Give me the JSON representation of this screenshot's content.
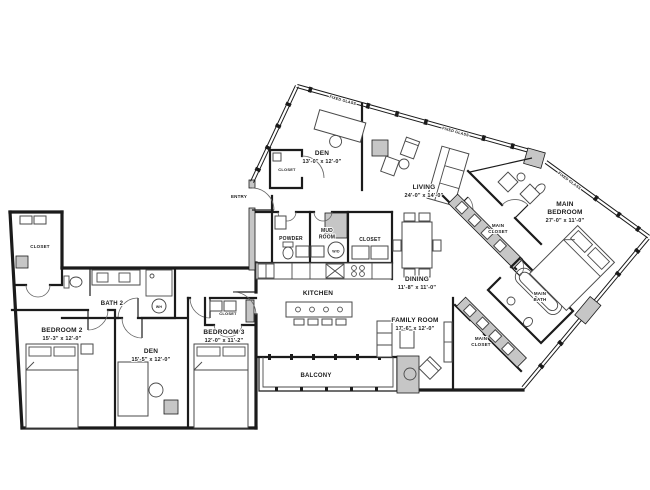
{
  "rooms": {
    "den_upper": {
      "name": "DEN",
      "dims": "13'-0\" x 12'-0\""
    },
    "living": {
      "name": "LIVING",
      "dims": "24'-0\" x 14'-0\""
    },
    "main_bedroom": {
      "l1": "MAIN",
      "l2": "BEDROOM",
      "dims": "27'-0\" x 11'-0\""
    },
    "dining": {
      "name": "DINING",
      "dims": "11'-8\" x 11'-0\""
    },
    "kitchen": {
      "name": "KITCHEN"
    },
    "family_room": {
      "name": "FAMILY ROOM",
      "dims": "17'-6\" x 12'-0\""
    },
    "bedroom_2": {
      "name": "BEDROOM 2",
      "dims": "15'-3\" x 12'-0\""
    },
    "den_lower": {
      "name": "DEN",
      "dims": "15'-5\" x 12'-0\""
    },
    "bedroom_3": {
      "name": "BEDROOM 3",
      "dims": "12'-0\" x 11'-2\""
    },
    "bath_2": {
      "name": "BATH 2"
    },
    "powder": {
      "name": "POWDER"
    },
    "mud_room": {
      "l1": "MUD",
      "l2": "ROOM"
    },
    "balcony": {
      "name": "BALCONY"
    },
    "entry": {
      "name": "ENTRY"
    },
    "main_bath": {
      "l1": "MAIN",
      "l2": "BATH"
    },
    "main_closet_upper": {
      "l1": "MAIN",
      "l2": "CLOSET"
    },
    "main_closet_lower": {
      "l1": "MAIN",
      "l2": "CLOSET"
    },
    "closet_den": {
      "name": "CLOSET"
    },
    "closet_bedroom_2": {
      "name": "CLOSET"
    },
    "closet_bedroom_3": {
      "name": "CLOSET"
    },
    "closet_hall": {
      "name": "CLOSET"
    }
  },
  "annotations": {
    "glass_1": "FIXED GLASS",
    "glass_2": "FIXED GLASS",
    "glass_3": "FIXED GLASS",
    "washer_dryer": "W/D",
    "water_heater": "WH"
  },
  "colors": {
    "wall": "#1b1b1b",
    "poche": "#c6c6c6",
    "furniture": "#4a4a4a",
    "background": "#ffffff"
  }
}
